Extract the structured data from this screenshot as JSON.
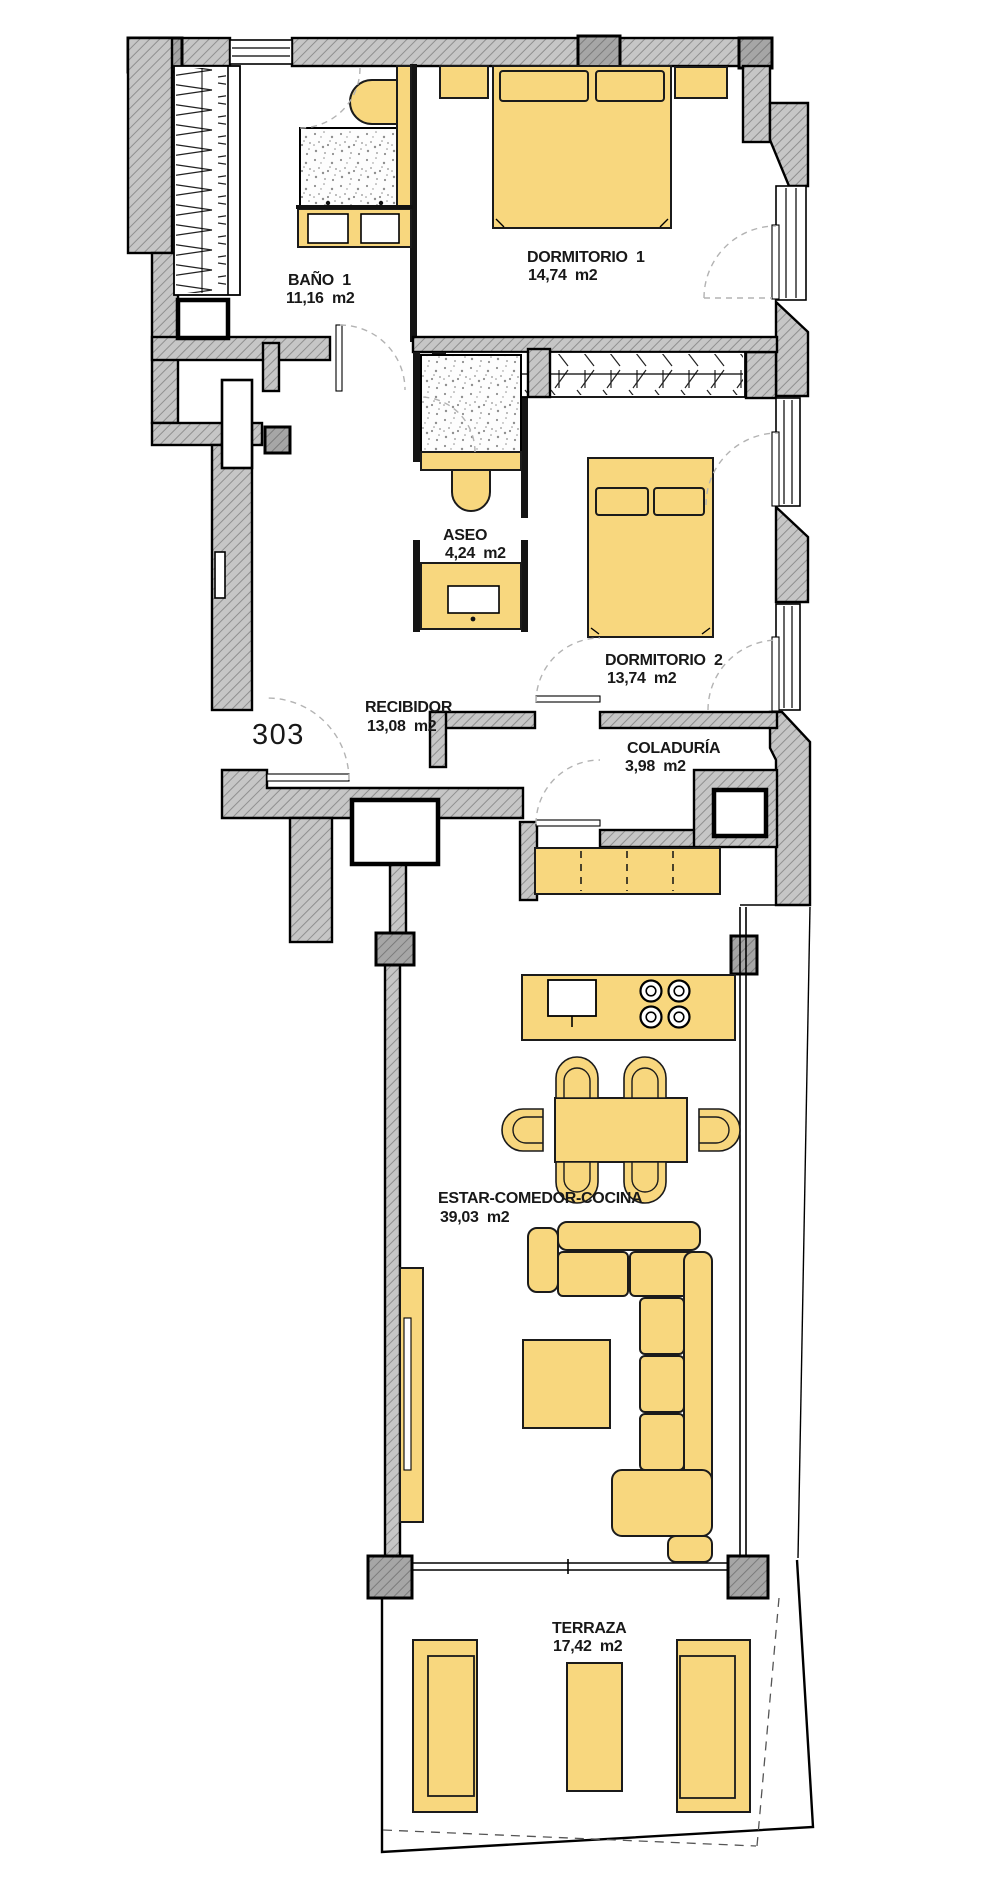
{
  "plan": {
    "unit_number": "303",
    "rooms": [
      {
        "id": "bano1",
        "name": "BAÑO  1",
        "area": "11,16  m2"
      },
      {
        "id": "dormitorio1",
        "name": "DORMITORIO  1",
        "area": "14,74  m2"
      },
      {
        "id": "aseo",
        "name": "ASEO",
        "area": "4,24  m2"
      },
      {
        "id": "dormitorio2",
        "name": "DORMITORIO  2",
        "area": "13,74  m2"
      },
      {
        "id": "recibidor",
        "name": "RECIBIDOR",
        "area": "13,08  m2"
      },
      {
        "id": "coladuria",
        "name": "COLADURÍA",
        "area": "3,98  m2"
      },
      {
        "id": "estar",
        "name": "ESTAR-COMEDOR-COCINA",
        "area": "39,03  m2"
      },
      {
        "id": "terraza",
        "name": "TERRAZA",
        "area": "17,42  m2"
      }
    ],
    "colors": {
      "furniture": "#F8D77E",
      "wall_fill": "#C6C6C6",
      "outline": "#000000",
      "door_arc": "#B3B3B3"
    }
  }
}
